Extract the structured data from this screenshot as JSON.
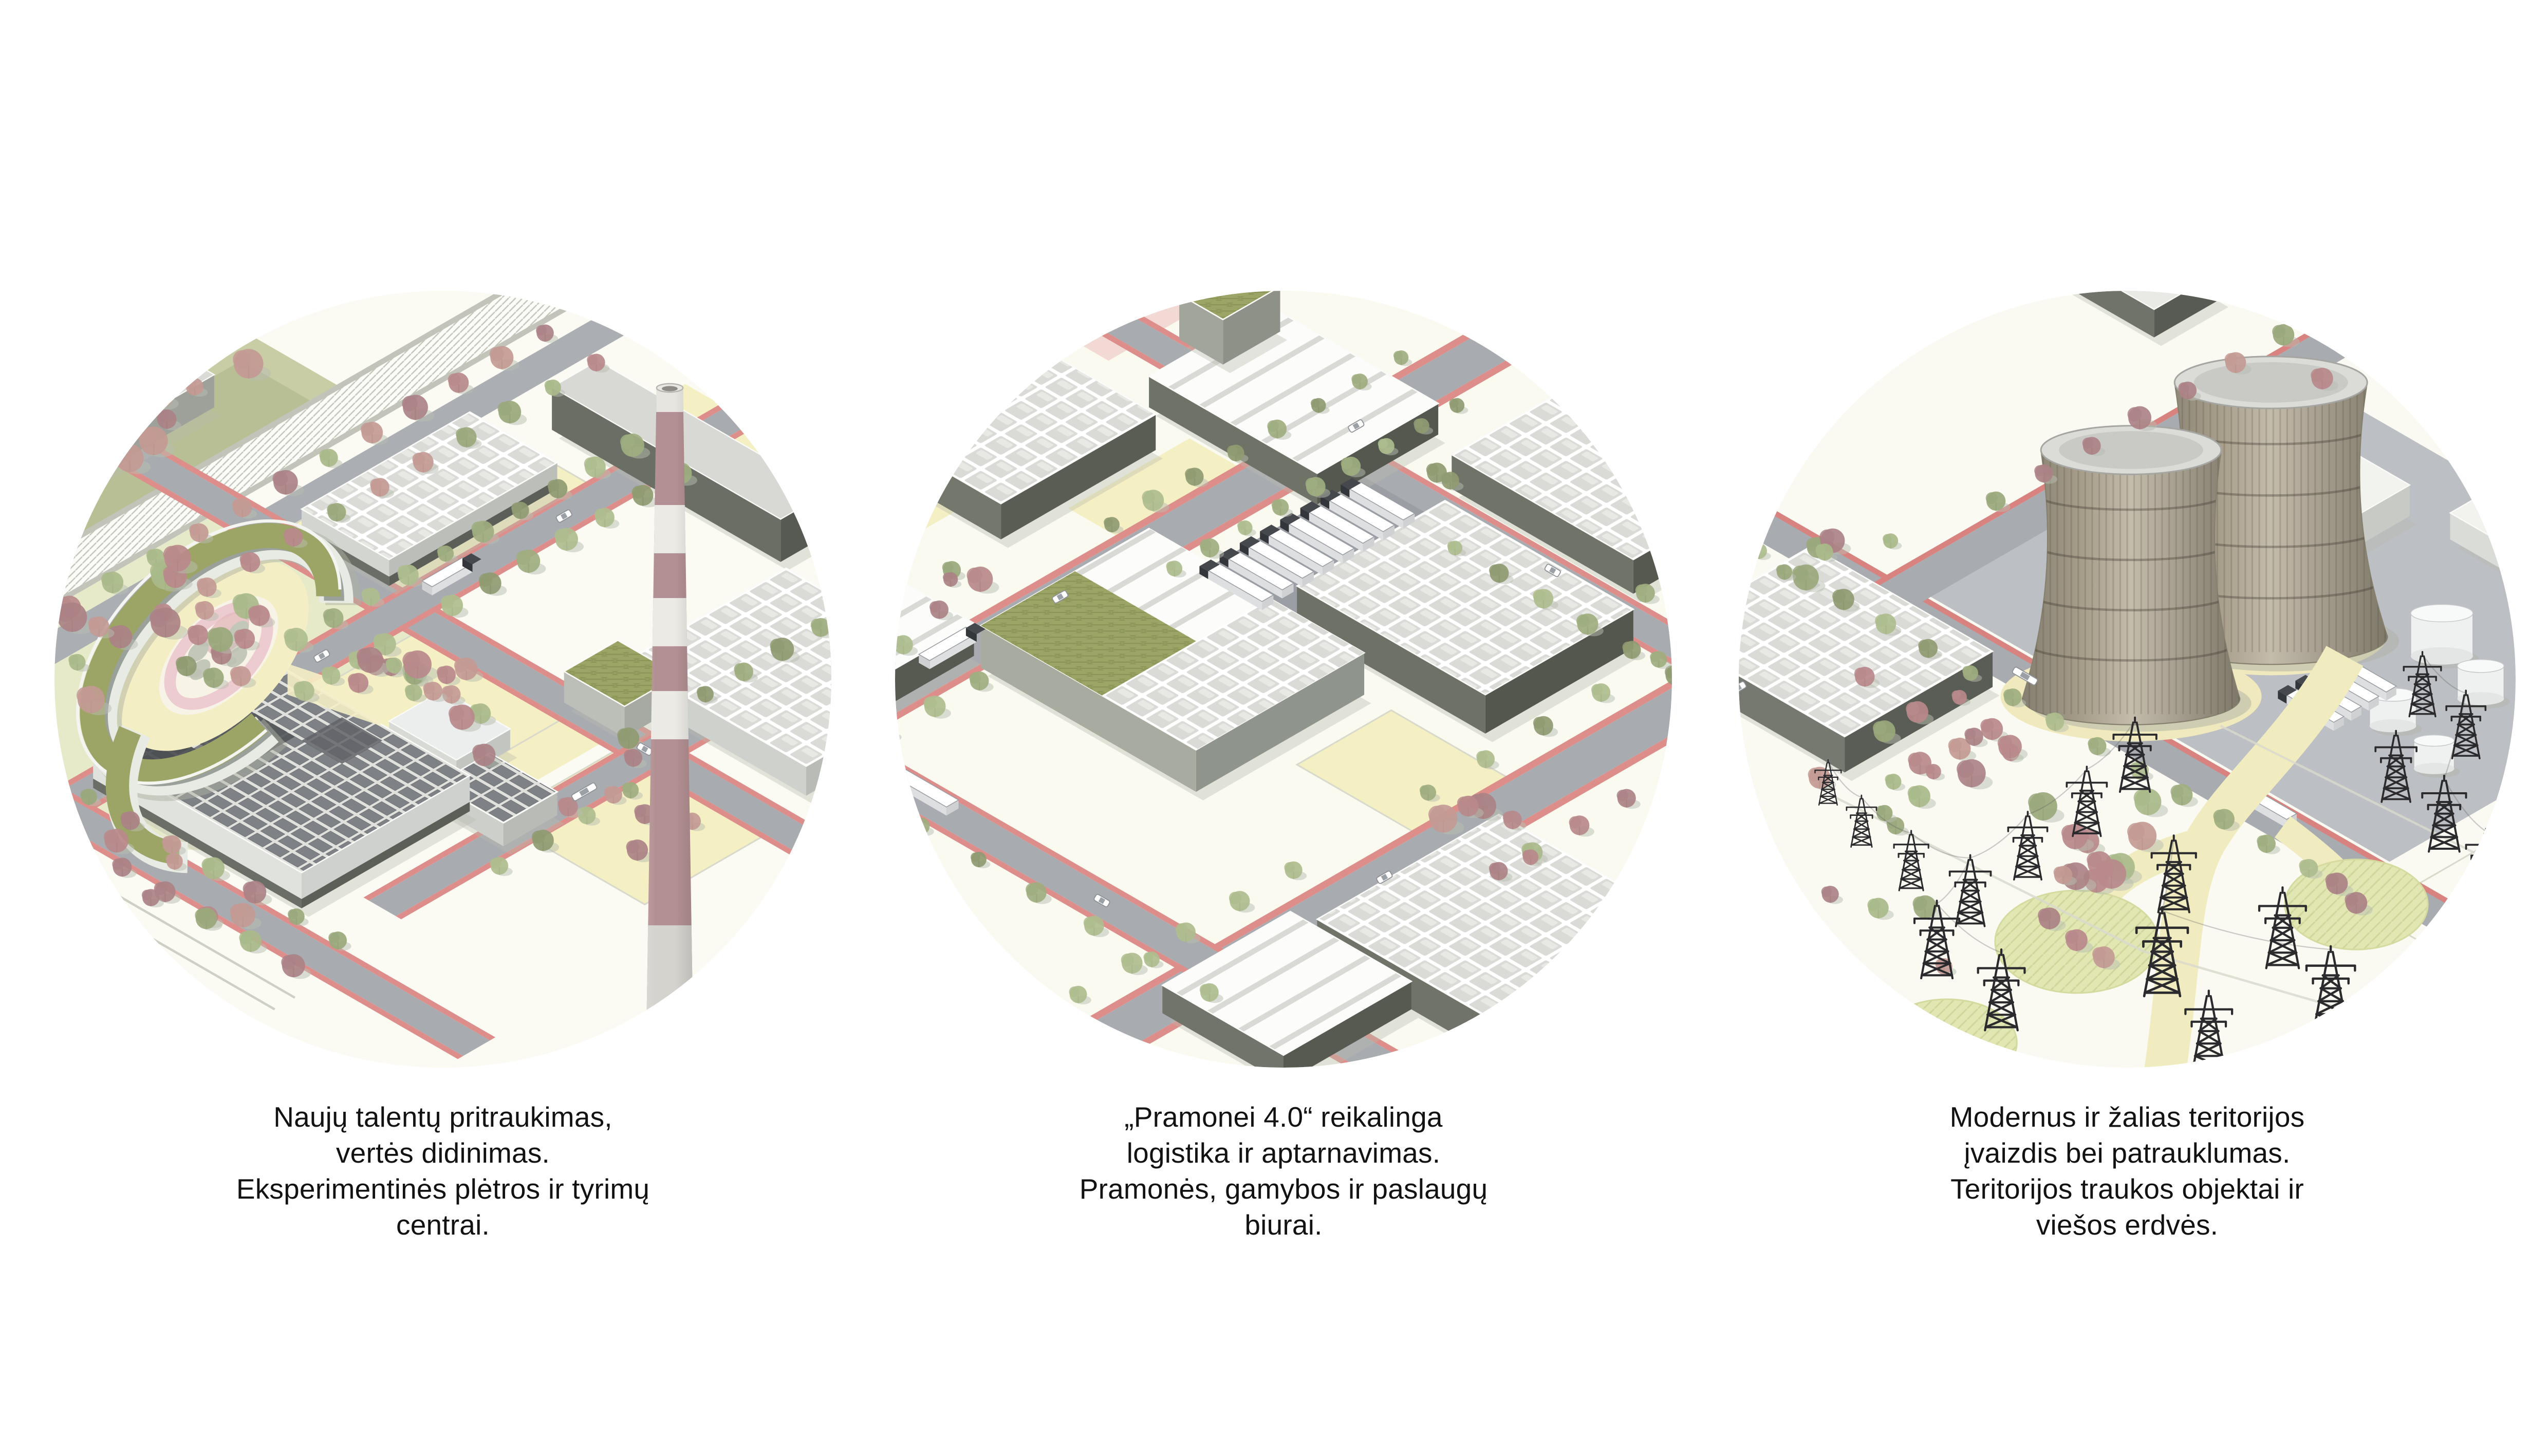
{
  "slide": {
    "background": "#ffffff",
    "panels": [
      {
        "name": "research-campus",
        "illustration": "isometric-campus-with-ring-building-and-striped-chimney",
        "caption": "Naujų talentų pritraukimas,\nvertės didinimas.\nEksperimentinės plėtros ir tyrimų\ncentrai."
      },
      {
        "name": "industry-logistics",
        "illustration": "isometric-logistics-district-with-warehouses-and-trucks",
        "caption": "„Pramonei 4.0“ reikalinga\nlogistika ir aptarnavimas.\nPramonės, gamybos ir paslaugų\nbiurai."
      },
      {
        "name": "green-territory",
        "illustration": "isometric-park-with-cooling-towers-and-pylons",
        "caption": "Modernus ir žalias teritorijos\nįvaizdis bei patrauklumas.\nTeritorijos traukos objektai ir\nviešos erdvės."
      }
    ],
    "palette": {
      "ground": "#fbfaf3",
      "plot_yellow": "#f5efc4",
      "road_gray": "#a8acb1",
      "bike_lane_red": "#dd8e8a",
      "green_roof": "#9ca466",
      "tree_red": "#b9898b",
      "tree_green": "#9aa87c",
      "chimney_rose": "#b39093",
      "facade_dark": "#5f635c",
      "caption_text": "#121212"
    }
  }
}
